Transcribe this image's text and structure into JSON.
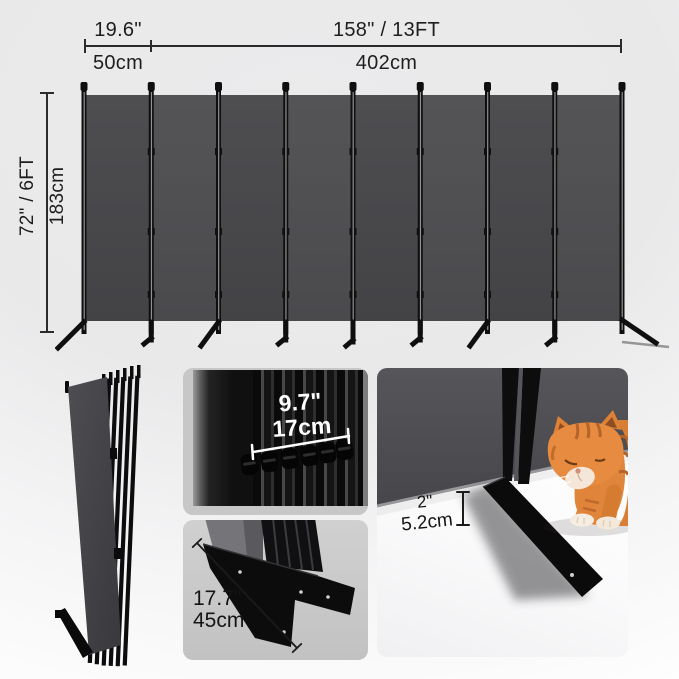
{
  "dimensions": {
    "panel_width": {
      "inches": "19.6\"",
      "cm": "50cm"
    },
    "total_width": {
      "inches": "158\" / 13FT",
      "cm": "402cm"
    },
    "height": {
      "inches": "72\" / 6FT",
      "cm": "183cm"
    },
    "folded_depth": {
      "inches": "9.7\"",
      "cm": "17cm"
    },
    "base_length": {
      "inches": "17.7\"",
      "cm": "45cm"
    },
    "ground_clearance": {
      "inches": "2\"",
      "cm": "5.2cm"
    }
  },
  "colors": {
    "panel_fabric": "#4a4a4d",
    "frame_black": "#0f0f10",
    "dimension_text": "#1e1e1e",
    "tile_background": "#c7c7c7",
    "background_top": "#ebebec",
    "background_bottom": "#ffffff",
    "cat_orange": "#e0863c"
  },
  "icons": {
    "cat_illustration": "orange-tabby-kitten-looking-at-base"
  },
  "panel_count": 8
}
